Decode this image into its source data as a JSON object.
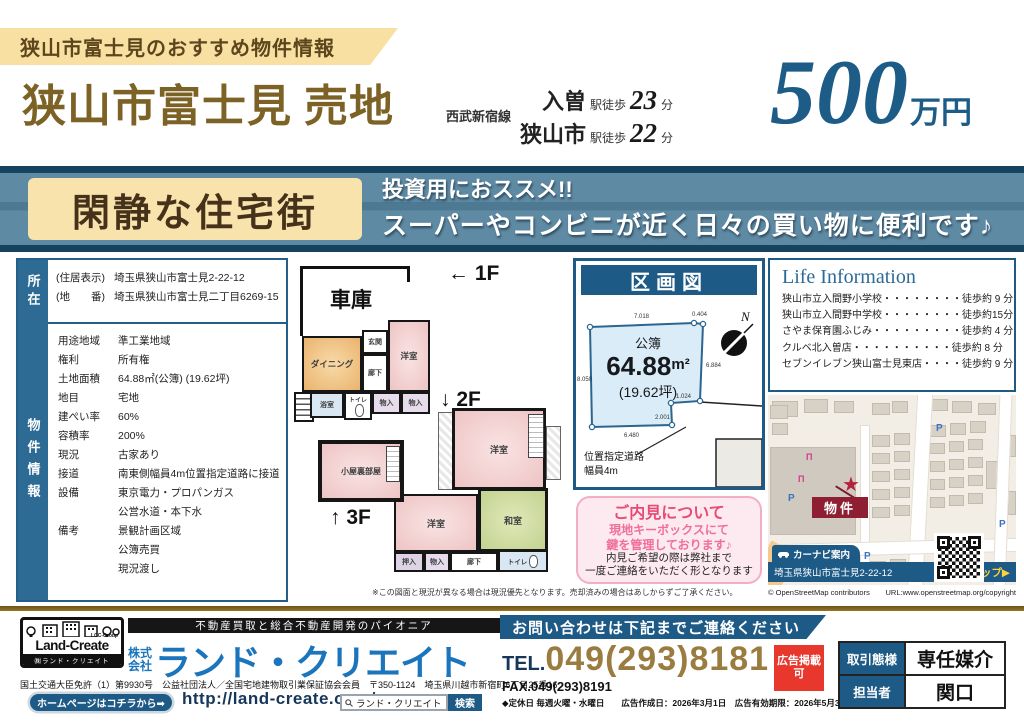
{
  "header": {
    "ribbon": "狭山市富士見のおすすめ物件情報",
    "title": "狭山市富士見 売地",
    "rail_line": "西武新宿線",
    "stations": [
      {
        "name": "入曽",
        "walk": "駅徒歩",
        "min": "23",
        "unit": "分"
      },
      {
        "name": "狭山市",
        "walk": "駅徒歩",
        "min": "22",
        "unit": "分"
      }
    ],
    "price": {
      "number": "500",
      "unit": "万円"
    }
  },
  "banner": {
    "badge": "閑静な住宅街",
    "line1": "投資用におススメ!!",
    "line2": "スーパーやコンビニが近く日々の買い物に便利です♪"
  },
  "property": {
    "side1": "所在",
    "side2": "物件情報",
    "addr": [
      {
        "k": "(住居表示)",
        "v": "埼玉県狭山市富士見2-22-12"
      },
      {
        "k": "(地　　番)",
        "v": "埼玉県狭山市富士見二丁目6269-15"
      }
    ],
    "rows": [
      {
        "k": "用途地域",
        "v": "準工業地域"
      },
      {
        "k": "権利",
        "v": "所有権"
      },
      {
        "k": "土地面積",
        "v": "64.88㎡(公簿) (19.62坪)"
      },
      {
        "k": "地目",
        "v": "宅地"
      },
      {
        "k": "建ぺい率",
        "v": "60%"
      },
      {
        "k": "容積率",
        "v": "200%"
      },
      {
        "k": "現況",
        "v": "古家あり"
      },
      {
        "k": "接道",
        "v": "南東側幅員4m位置指定道路に接道"
      },
      {
        "k": "設備",
        "v": "東京電力・プロパンガス"
      },
      {
        "k": "",
        "v": "公営水道・本下水"
      },
      {
        "k": "備考",
        "v": "景観計画区域"
      },
      {
        "k": "",
        "v": "公簿売買"
      },
      {
        "k": "",
        "v": "現況渡し"
      }
    ]
  },
  "floorplan": {
    "f1": "← 1F",
    "f2": "↓ 2F",
    "f3": "↑ 3F",
    "garage": "車庫",
    "dining": "ダイニング",
    "entrance": "玄関",
    "hallway1": "廊下",
    "western1": "洋室",
    "bathroom": "浴室",
    "toilet1": "トイレ",
    "storage1": "物入",
    "storage2": "物入",
    "attic": "小屋裏部屋",
    "western2": "洋室",
    "western3": "洋室",
    "japanese_room": "和室",
    "oshiire": "押入",
    "storage3": "物入",
    "hallway2": "廊下",
    "toilet2": "トイレ",
    "balcony": "バルコニー",
    "disclaimer": "※この図面と現況が異なる場合は現況優先となります。売却済みの場合はあしからずご了承ください。"
  },
  "lot": {
    "title": "区画図",
    "register": "公簿",
    "area": "64.88",
    "area_unit": "m²",
    "tsubo": "(19.62坪)",
    "compass": "N",
    "dims": {
      "top": "7.018",
      "top2": "0.404",
      "right": "6.884",
      "left": "8.050",
      "notch_w": "1.024",
      "notch_h": "2.001",
      "bottom": "6.480"
    },
    "road1": "位置指定道路",
    "road2": "幅員4m"
  },
  "viewing": {
    "title": "ご内見について",
    "line1": "現地キーボックスにて",
    "line2": "鍵を管理しております♪",
    "line3": "内見ご希望の際は弊社まで",
    "line4": "一度ご連絡をいただく形となります"
  },
  "life": {
    "title": "Life Information",
    "items": [
      {
        "name": "狭山市立入間野小学校",
        "dots": "・・・・・・・・",
        "time": "徒歩約 9 分"
      },
      {
        "name": "狭山市立入間野中学校",
        "dots": "・・・・・・・・",
        "time": "徒歩約15分"
      },
      {
        "name": "さやま保育園ふじみ",
        "dots": "・・・・・・・・・",
        "time": "徒歩約 4 分"
      },
      {
        "name": "クルベ北入曽店",
        "dots": "・・・・・・・・・・",
        "time": "徒歩約 8 分"
      },
      {
        "name": "セブンイレブン狭山富士見東店",
        "dots": "・・・・",
        "time": "徒歩約 9 分"
      }
    ]
  },
  "map": {
    "marker": "物件",
    "navi": "カーナビ案内",
    "address": "埼玉県狭山市富士見2-22-12",
    "maplink": "現地マップ▶",
    "p": "P",
    "attribution": "© OpenStreetMap contributors",
    "url": "URL:www.openstreetmap.org/copyright"
  },
  "footer": {
    "tagline": "不動産買取と総合不動産開発のパイオニア",
    "logo_name": "Land-Create",
    "logo_group": "LCC-Group",
    "logo_sub": "㈱ランド・クリエイト",
    "prefix1": "株式",
    "prefix2": "会社",
    "company": "ランド・クリエイト",
    "license": "国土交通大臣免許（1）第9930号　公益社団法人／全国宅地建物取引業保証協会会員　〒350-1124　埼玉県川越市新宿町6丁目25番16",
    "hp_btn": "ホームページはコチラから➡",
    "url": "http://land-create.com/",
    "search_text": "ランド・クリエイト",
    "search_btn": "検索",
    "contact": "お問い合わせは下記までご連絡ください",
    "tel_label": "TEL.",
    "tel": "049(293)8181",
    "fax": "FAX.049(293)8191",
    "ad1": "広告掲載",
    "ad2": "可",
    "note": "◆定休日 毎週火曜・水曜日　　広告作成日：2026年3月1日　広告有効期限：2026年5月31日",
    "t1k": "取引態様",
    "t1v": "専任媒介",
    "t2k": "担当者",
    "t2v": "関口"
  }
}
